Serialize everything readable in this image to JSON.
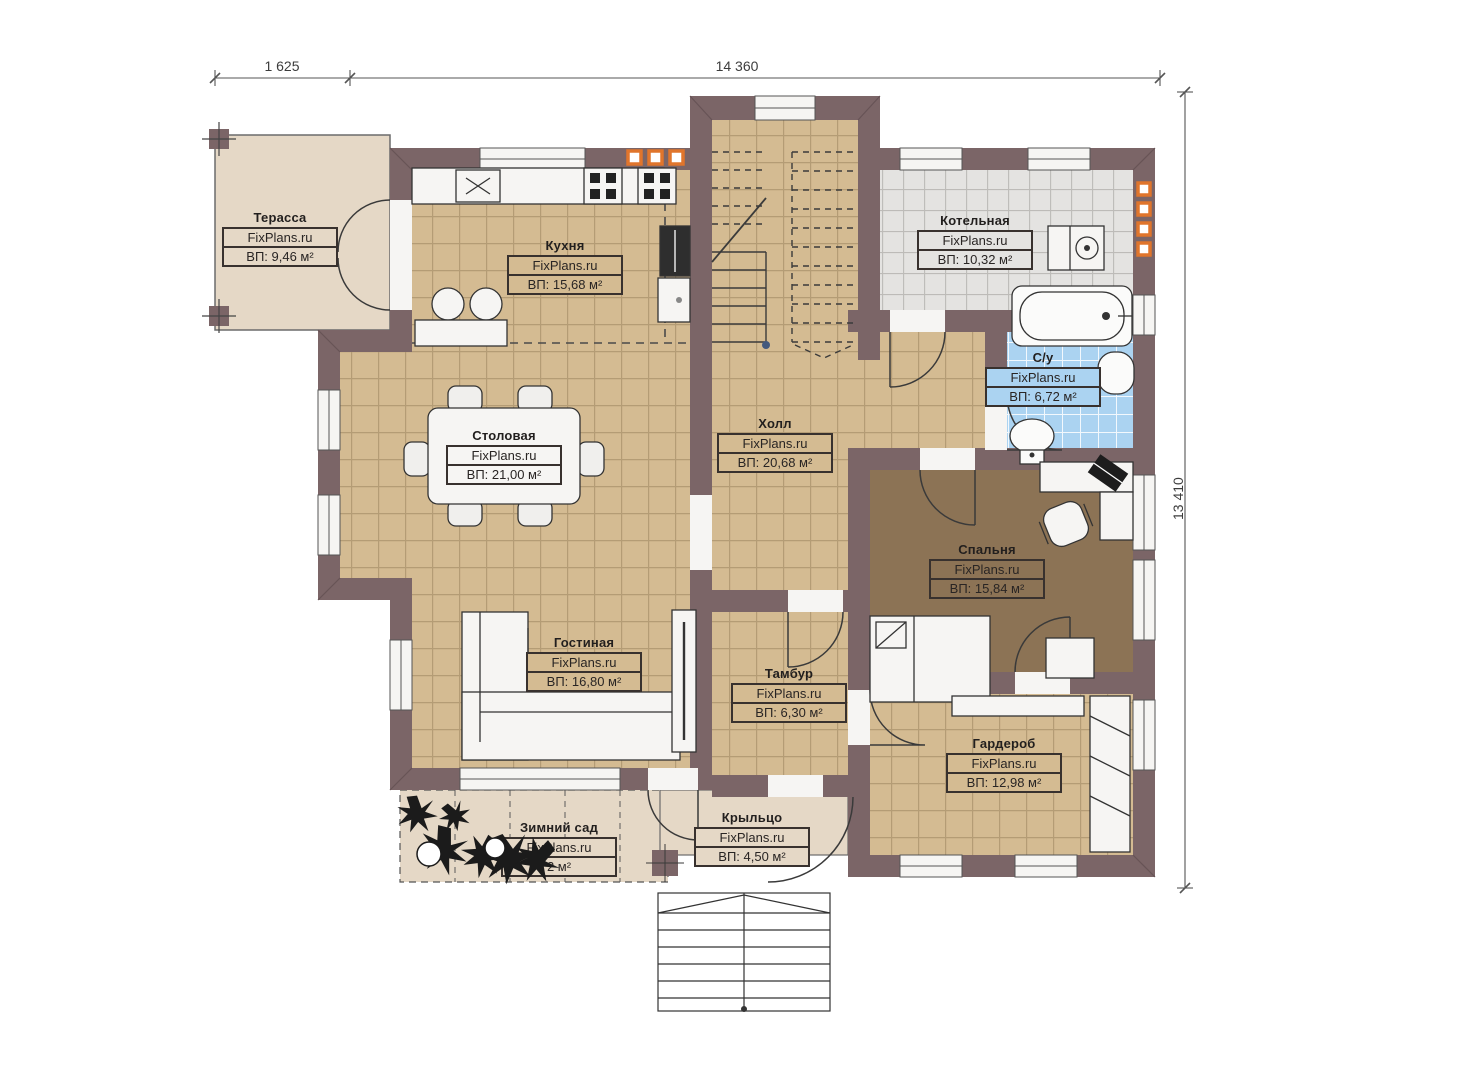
{
  "plan_title": "First floor plan",
  "watermark": "FixPlans.ru",
  "dimensions": {
    "top_left": "1 625",
    "top_main": "14 360",
    "right": "13 410"
  },
  "rooms": [
    {
      "id": "terrace",
      "name": "Терасса",
      "brand": "FixPlans.ru",
      "area": "ВП: 9,46 м²"
    },
    {
      "id": "kitchen",
      "name": "Кухня",
      "brand": "FixPlans.ru",
      "area": "ВП: 15,68 м²"
    },
    {
      "id": "boiler",
      "name": "Котельная",
      "brand": "FixPlans.ru",
      "area": "ВП: 10,32 м²"
    },
    {
      "id": "bathroom",
      "name": "С/у",
      "brand": "FixPlans.ru",
      "area": "ВП: 6,72 м²"
    },
    {
      "id": "hall",
      "name": "Холл",
      "brand": "FixPlans.ru",
      "area": "ВП: 20,68 м²"
    },
    {
      "id": "dining",
      "name": "Столовая",
      "brand": "FixPlans.ru",
      "area": "ВП: 21,00 м²"
    },
    {
      "id": "bedroom",
      "name": "Спальня",
      "brand": "FixPlans.ru",
      "area": "ВП: 15,84 м²"
    },
    {
      "id": "living",
      "name": "Гостиная",
      "brand": "FixPlans.ru",
      "area": "ВП: 16,80 м²"
    },
    {
      "id": "vestibule",
      "name": "Тамбур",
      "brand": "FixPlans.ru",
      "area": "ВП: 6,30 м²"
    },
    {
      "id": "wardrobe",
      "name": "Гардероб",
      "brand": "FixPlans.ru",
      "area": "ВП: 12,98 м²"
    },
    {
      "id": "wintergarden",
      "name": "Зимний сад",
      "brand": "FixPlans.ru",
      "area": "2 м²"
    },
    {
      "id": "porch",
      "name": "Крыльцо",
      "brand": "FixPlans.ru",
      "area": "ВП: 4,50 м²"
    }
  ],
  "colors": {
    "wall": "#7B6567",
    "tile_floor": "#D4BB92",
    "boiler_floor": "#E4E3E1",
    "bathroom_tile": "#ABD3F1",
    "bedroom_floor": "#8C7355",
    "terrace_floor": "#E5D8C6",
    "vent_orange": "#E0752C"
  }
}
